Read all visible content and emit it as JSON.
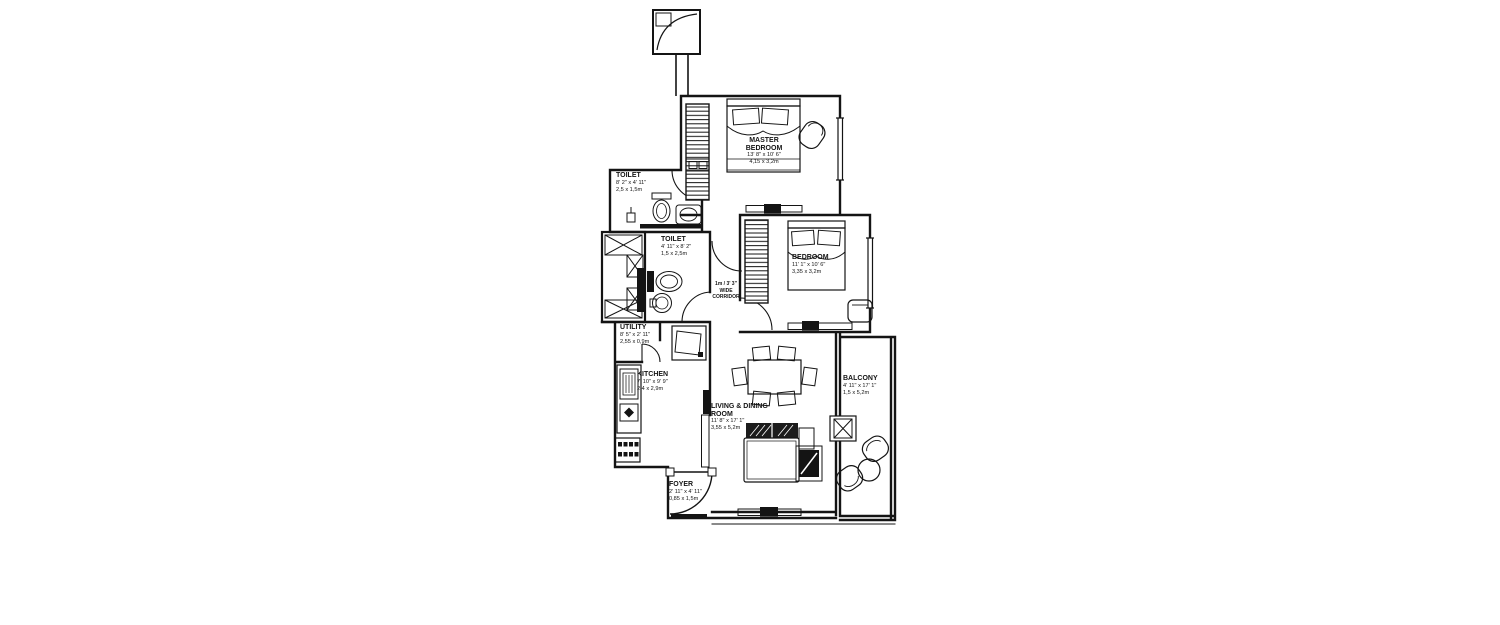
{
  "colors": {
    "line": "#141414",
    "background": "#ffffff"
  },
  "rooms": [
    {
      "id": "master-bedroom",
      "name": "MASTER\nBEDROOM",
      "imperial": "13' 8\" x 10' 6\"",
      "metric": "4,15 x 3,2m"
    },
    {
      "id": "bedroom",
      "name": "BEDROOM",
      "imperial": "11' 1\" x 10' 6\"",
      "metric": "3,35 x 3,2m"
    },
    {
      "id": "toilet-top",
      "name": "TOILET",
      "imperial": "8' 2\" x 4' 11\"",
      "metric": "2,5 x 1,5m"
    },
    {
      "id": "toilet-mid",
      "name": "TOILET",
      "imperial": "4' 11\" x 8' 2\"",
      "metric": "1,5 x 2,5m"
    },
    {
      "id": "utility",
      "name": "UTILITY",
      "imperial": "8' 5\" x 2' 11\"",
      "metric": "2,55 x 0,9m"
    },
    {
      "id": "kitchen",
      "name": "KITCHEN",
      "imperial": "7' 10\" x 9' 9\"",
      "metric": "2,4 x 2,9m"
    },
    {
      "id": "living-dining",
      "name": "LIVING & DINING\nROOM",
      "imperial": "11' 8\" x 17' 1\"",
      "metric": "3,55 x 5,2m"
    },
    {
      "id": "balcony",
      "name": "BALCONY",
      "imperial": "4' 11\" x 17' 1\"",
      "metric": "1,5 x 5,2m"
    },
    {
      "id": "foyer",
      "name": "FOYER",
      "imperial": "2' 11\" x 4' 11\"",
      "metric": "0,85 x 1,5m"
    }
  ],
  "corridor": {
    "label": "1m / 3' 3\"\nWIDE\nCORRIDOR"
  }
}
